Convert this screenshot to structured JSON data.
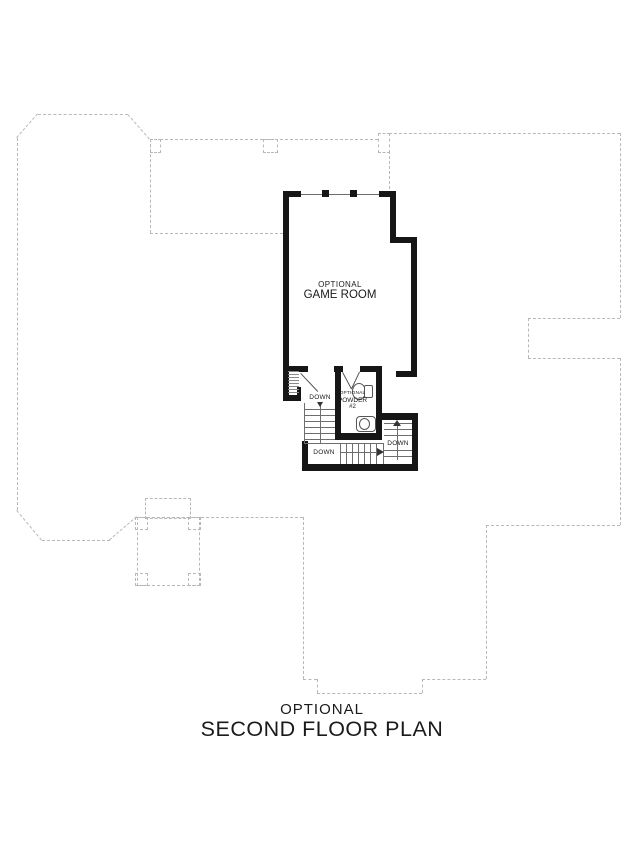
{
  "drawing_type": "architectural floor plan",
  "title": {
    "prefix": "OPTIONAL",
    "name": "SECOND FLOOR PLAN"
  },
  "labels": {
    "game_room": {
      "line1": "OPTIONAL",
      "line2": "GAME ROOM"
    },
    "powder_room": {
      "line1": "OPTIONAL",
      "line2": "POWDER",
      "line3": "#2"
    },
    "stair_down_center": "DOWN",
    "stair_down_bottom": "DOWN",
    "stair_down_right": "DOWN"
  },
  "colors": {
    "walls": "#161616",
    "dashed_outline": "#b8b8b8",
    "thin_lines": "#6e6e6e",
    "text": "#1a1a1a",
    "background": "#ffffff"
  }
}
